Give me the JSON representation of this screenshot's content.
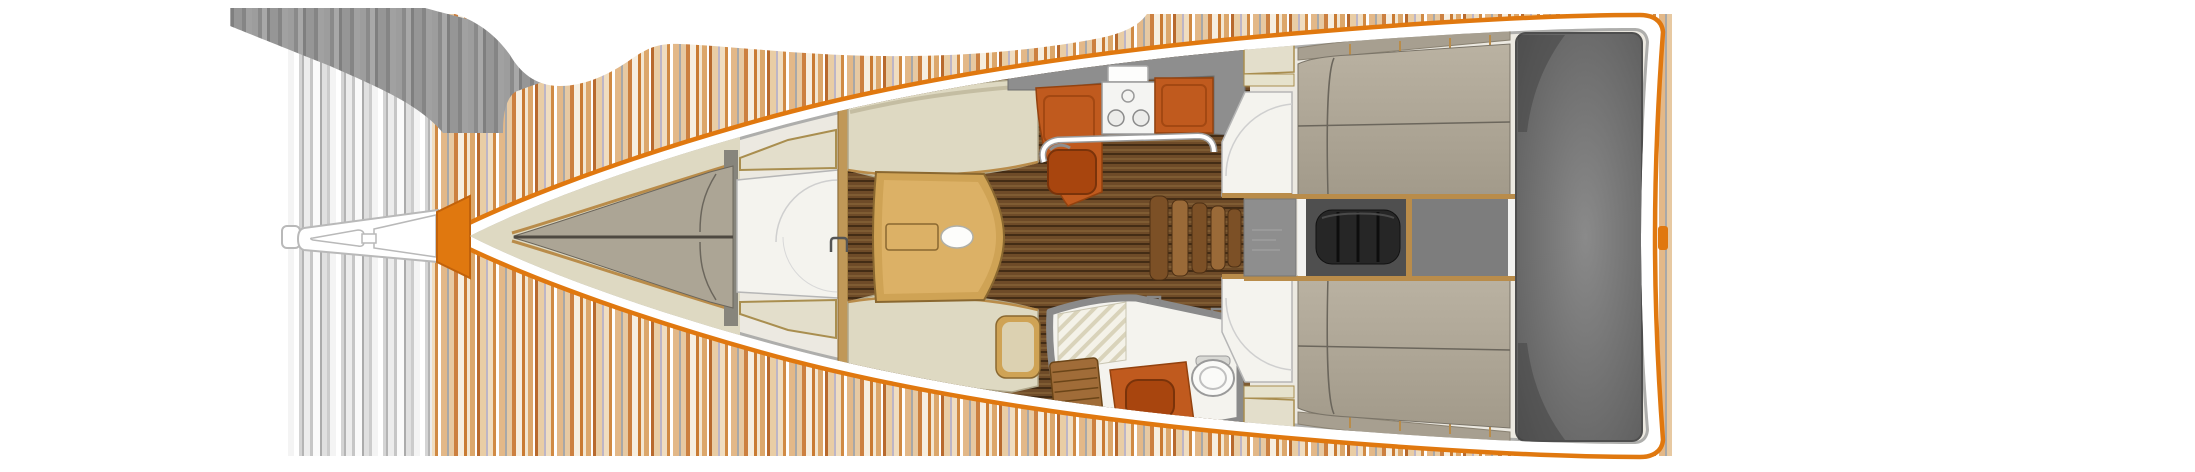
{
  "figure": {
    "type": "boat-floor-plan",
    "width": 2195,
    "height": 472,
    "view": "overhead interior layout, bow pointing left"
  },
  "palette": {
    "hull_outline": "#e0780f",
    "hull_stem": "#e0780f",
    "hull_band": "#ffffff",
    "interior_base": "#ece9e1",
    "deck_gray": "#9a9a9a",
    "wall_gray": "#8e8e8e",
    "wood_trim": "#b98c4a",
    "wood_dark": "#8a6830",
    "bulkhead_wood": "#c09858",
    "table_wood": "#cfa355",
    "table_light": "#dcb166",
    "floor_plank": "#6e4b28",
    "cushion_cream": "#ded9c2",
    "locker_cream": "#e3decb",
    "vberth_gray": "#aca595",
    "aft_berth_gray": "#b2aa9a",
    "shelf_taupe": "#a79f90",
    "counter_orange": "#c05a1e",
    "basin_orange": "#a8450e",
    "stove_white": "#f4f4f2",
    "white_floor": "#f4f3ee",
    "step_wood": "#7c5026",
    "step_wood_light": "#9a6a38",
    "engine_black": "#262626",
    "engine_bay_dark": "#4f4f4f",
    "aft_bay_gray": "#7d7d7d",
    "cockpit_gray": "#7d7d7d",
    "teak_grate": "#a06c38",
    "toilet_white": "#fafaf8",
    "stripe_orange": "#cc8040",
    "stripe_tan": "#e3b888",
    "stripe_cream": "#f2e6d1",
    "stripe_gray": "#c6c6c6",
    "blob_gray": "#969696",
    "cloud_white": "#ffffff"
  },
  "regions": [
    {
      "id": "bowsprit",
      "description": "bowsprit and anchor roller"
    },
    {
      "id": "forward-cabin",
      "description": "forward V-berth cabin"
    },
    {
      "id": "forward-head",
      "description": "forward head compartment"
    },
    {
      "id": "saloon",
      "description": "saloon with table and settees"
    },
    {
      "id": "galley",
      "description": "galley with stove and sink"
    },
    {
      "id": "companionway",
      "description": "companionway steps"
    },
    {
      "id": "aft-head",
      "description": "aft head with shower, sink, toilet"
    },
    {
      "id": "starboard-aft-cabin",
      "description": "upper aft double cabin"
    },
    {
      "id": "port-aft-cabin",
      "description": "lower aft double cabin"
    },
    {
      "id": "engine-compartment",
      "description": "engine machinery space"
    },
    {
      "id": "cockpit",
      "description": "cockpit / stern area"
    }
  ]
}
